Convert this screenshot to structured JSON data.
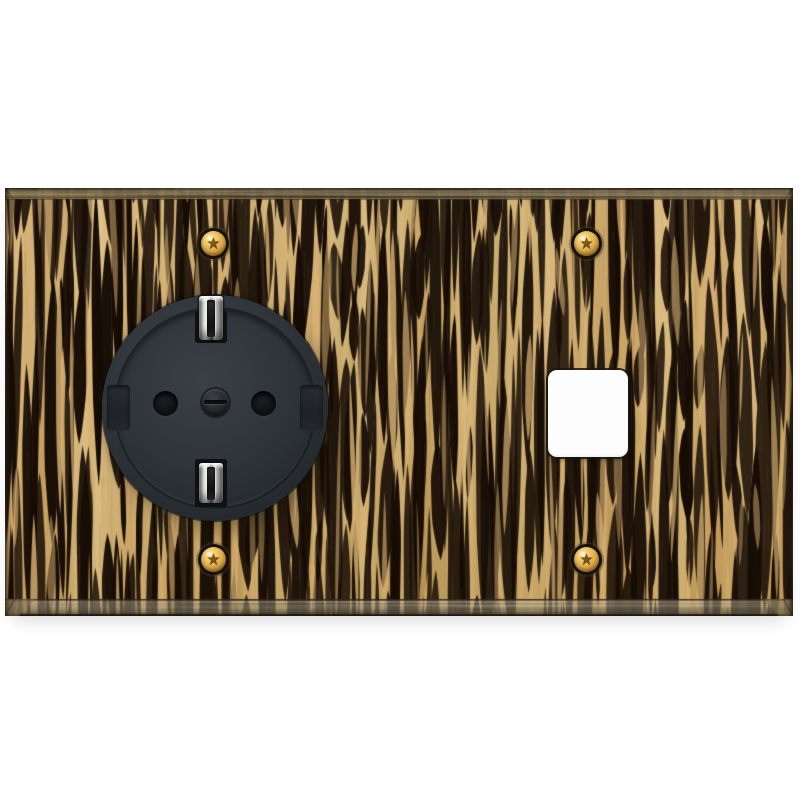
{
  "meta": {
    "caption": "Product photo: horizontal two-gang wall plate faced with black-and-tan striped zebrano wood veneer and antique bronze bevelled edges, holding a black Schuko grounded power socket on the left and an empty white square module opening on the right, fixed with four brass torx screws."
  },
  "colors": {
    "background": "#ffffff",
    "wood_light": "#d6ae72",
    "wood_mid": "#cda263",
    "wood_dark": "#190f07",
    "bevel_bronze": "#8a7852",
    "bevel_bronze_dark": "#3e3526",
    "bevel_bottom_gray": "#948b76",
    "socket_body": "#2f353a",
    "socket_dark": "#1e2226",
    "pin_hole": "#0e1114",
    "clip_metal_light": "#f2f2ee",
    "clip_metal_dark": "#55534e",
    "screw_gold_light": "#ffe9a8",
    "screw_gold": "#dcab4f",
    "screw_gold_dark": "#8f6520",
    "screw_ring": "#16120d",
    "module_white": "#fdfdfd"
  },
  "plate": {
    "face_material": "zebrano-wood-veneer",
    "edge_material": "antique-bronze",
    "gang_count": 2,
    "screw_count": 4
  },
  "left_gang": {
    "component": "schuko-power-socket",
    "pin_hole_count": 2,
    "earth_clip_count": 2,
    "side_notch_count": 2,
    "center_screw_count": 1
  },
  "right_gang": {
    "component": "empty-square-module-opening"
  }
}
